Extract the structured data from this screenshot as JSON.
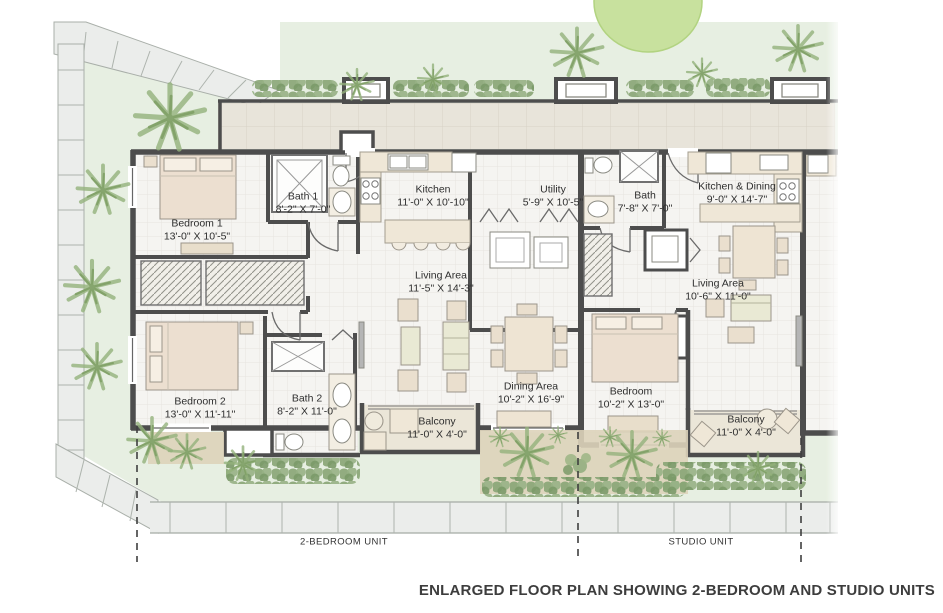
{
  "meta": {
    "caption": "ENLARGED FLOOR PLAN SHOWING 2-BEDROOM AND STUDIO UNITS"
  },
  "units": [
    {
      "id": "two_bedroom",
      "label": "2-BEDROOM UNIT"
    },
    {
      "id": "studio",
      "label": "STUDIO UNIT"
    }
  ],
  "rooms": [
    {
      "id": "bedroom1",
      "name": "Bedroom 1",
      "dims": "13'-0\" X 10'-5\""
    },
    {
      "id": "bath1",
      "name": "Bath 1",
      "dims": "8'-2\" X 7'-0\""
    },
    {
      "id": "kitchen",
      "name": "Kitchen",
      "dims": "11'-0\" X 10'-10\""
    },
    {
      "id": "utility",
      "name": "Utility",
      "dims": "5'-9\" X 10'-5\""
    },
    {
      "id": "bath_studio",
      "name": "Bath",
      "dims": "7'-8\" X 7'-0\""
    },
    {
      "id": "kitchen_dining",
      "name": "Kitchen & Dining",
      "dims": "9'-0\" X 14'-7\""
    },
    {
      "id": "living_2br",
      "name": "Living Area",
      "dims": "11'-5\" X 14'-3\""
    },
    {
      "id": "dining",
      "name": "Dining Area",
      "dims": "10'-2\" X 16'-9\""
    },
    {
      "id": "bedroom2",
      "name": "Bedroom 2",
      "dims": "13'-0\" X 11'-11\""
    },
    {
      "id": "bath2",
      "name": "Bath 2",
      "dims": "8'-2\" X 11'-0\""
    },
    {
      "id": "balcony_2br",
      "name": "Balcony",
      "dims": "11'-0\" X 4'-0\""
    },
    {
      "id": "living_studio",
      "name": "Living Area",
      "dims": "10'-6\" X 11'-0\""
    },
    {
      "id": "bedroom_studio",
      "name": "Bedroom",
      "dims": "10'-2\" X 13'-0\""
    },
    {
      "id": "balcony_studio",
      "name": "Balcony",
      "dims": "11'-0\" X 4'-0\""
    }
  ],
  "colors": {
    "wall": "#4d4d4d",
    "room_floor": "#f5f4f1",
    "corridor_floor": "#e8e4da",
    "balcony_floor": "#ebe6d8",
    "furniture_tan": "#eadfce",
    "lawn": "#e7efe2",
    "paving": "#ebedeb",
    "planting_green": "#8fab7c",
    "planter_sand": "#ddd3ba"
  }
}
